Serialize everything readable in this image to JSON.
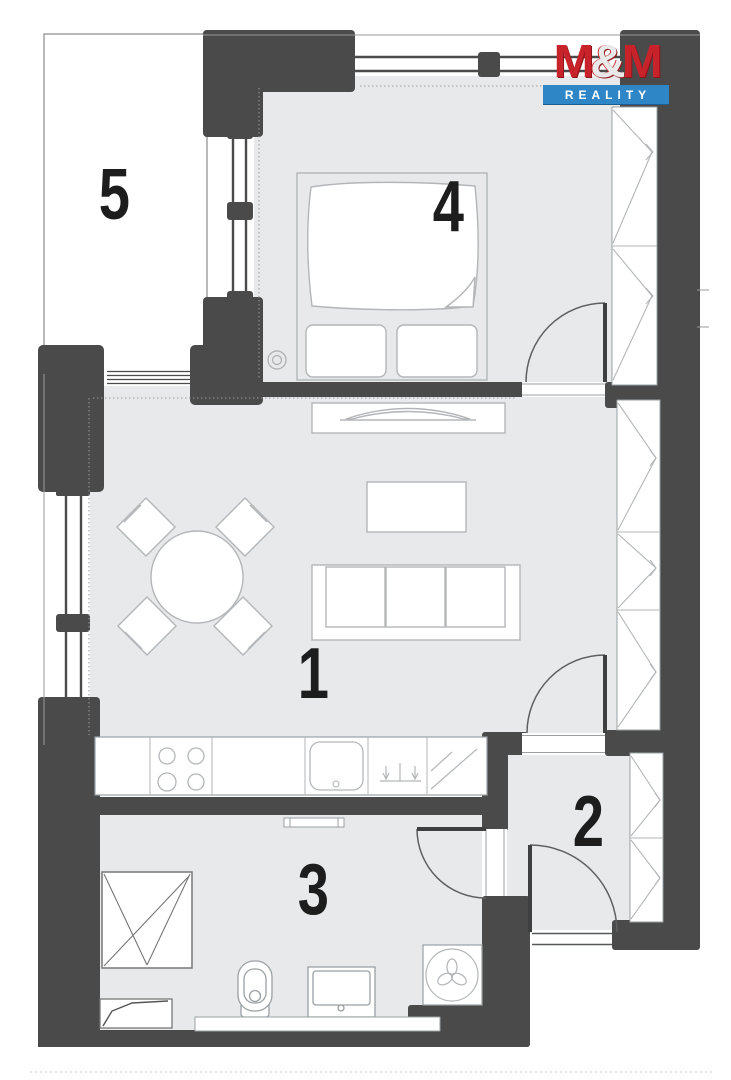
{
  "brand": {
    "m1": "M",
    "amp": "&",
    "m2": "M",
    "subtitle": "REALITY",
    "primary_red": "#c8232b",
    "primary_blue": "#2e86c6"
  },
  "rooms": [
    {
      "number": "1"
    },
    {
      "number": "2"
    },
    {
      "number": "3"
    },
    {
      "number": "4"
    },
    {
      "number": "5"
    }
  ],
  "palette": {
    "wall": "#4a4a4b",
    "floor": "#e8e9ea",
    "furniture_line": "#b3b6b8",
    "door_line": "#5f5f5f",
    "outline": "#8a8a8a"
  }
}
